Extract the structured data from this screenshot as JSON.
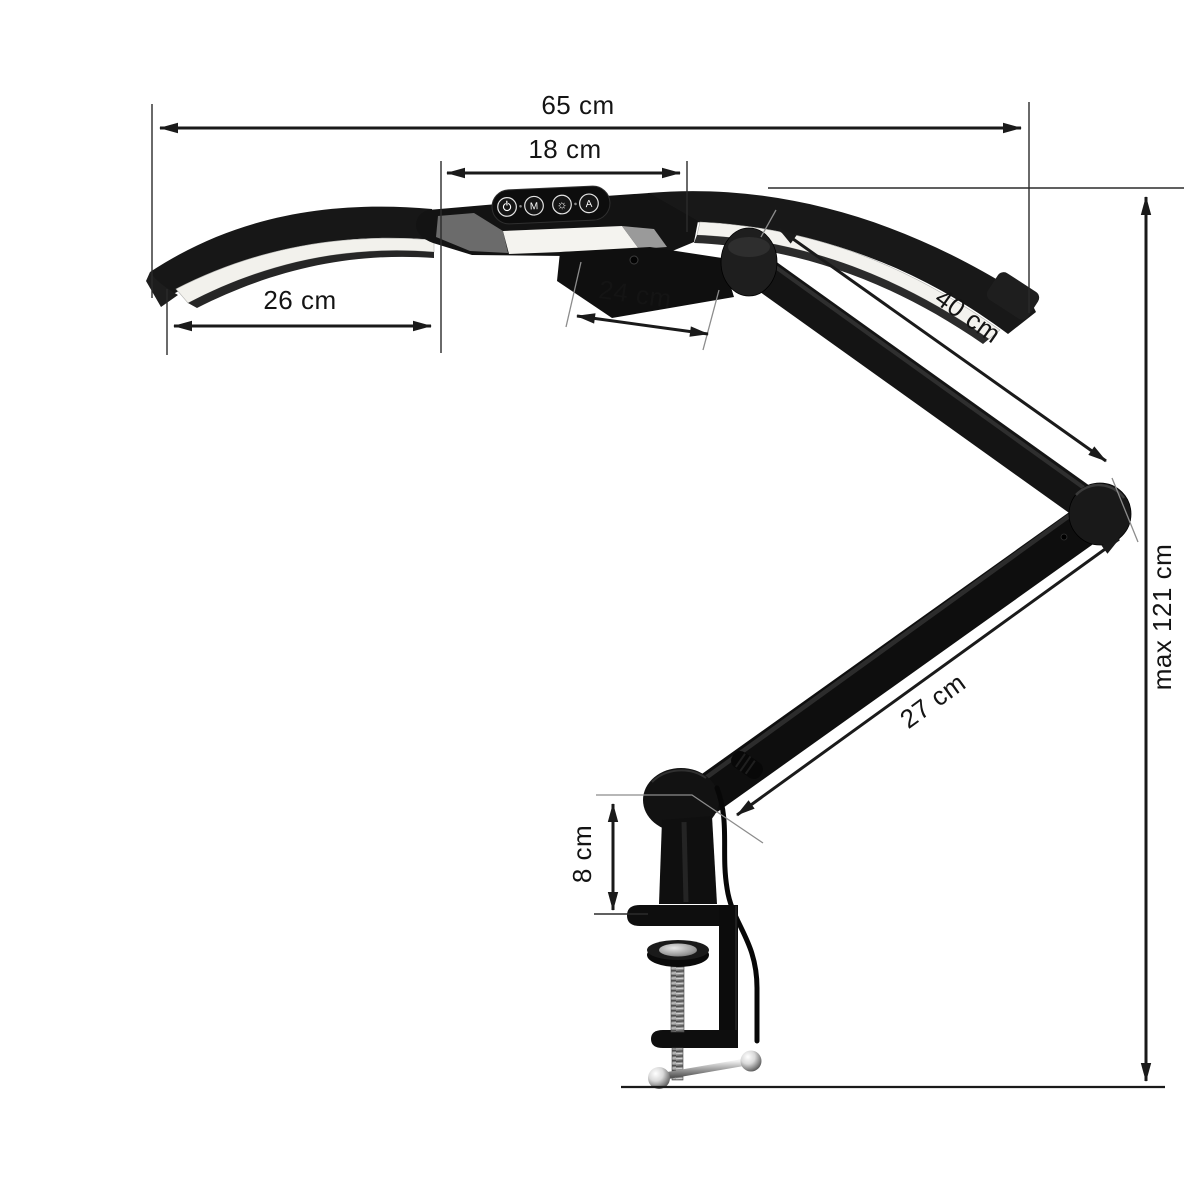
{
  "page": {
    "background": "#ffffff",
    "description": "Dimension diagram of a dual-wing LED desk lamp on an articulated arm with a table clamp"
  },
  "dimensions": {
    "total_width": {
      "label": "65 cm"
    },
    "head_width": {
      "label": "18 cm"
    },
    "wing_length": {
      "label": "26 cm"
    },
    "head_depth": {
      "label": "24 cm"
    },
    "upper_arm": {
      "label": "40 cm"
    },
    "lower_arm": {
      "label": "27 cm"
    },
    "max_height": {
      "label": "max 121 cm"
    },
    "clamp_height": {
      "label": "8 cm"
    }
  },
  "control_panel": {
    "buttons": [
      {
        "name": "power",
        "icon": "power-icon"
      },
      {
        "name": "mode",
        "glyph": "M"
      },
      {
        "name": "brightness",
        "glyph": "☼"
      },
      {
        "name": "auto",
        "glyph": "A"
      }
    ]
  },
  "colors": {
    "dimension_line": "#1a1a1a",
    "lamp_body": "#141414",
    "led_strip": "#f3f2ee",
    "background": "#ffffff"
  }
}
